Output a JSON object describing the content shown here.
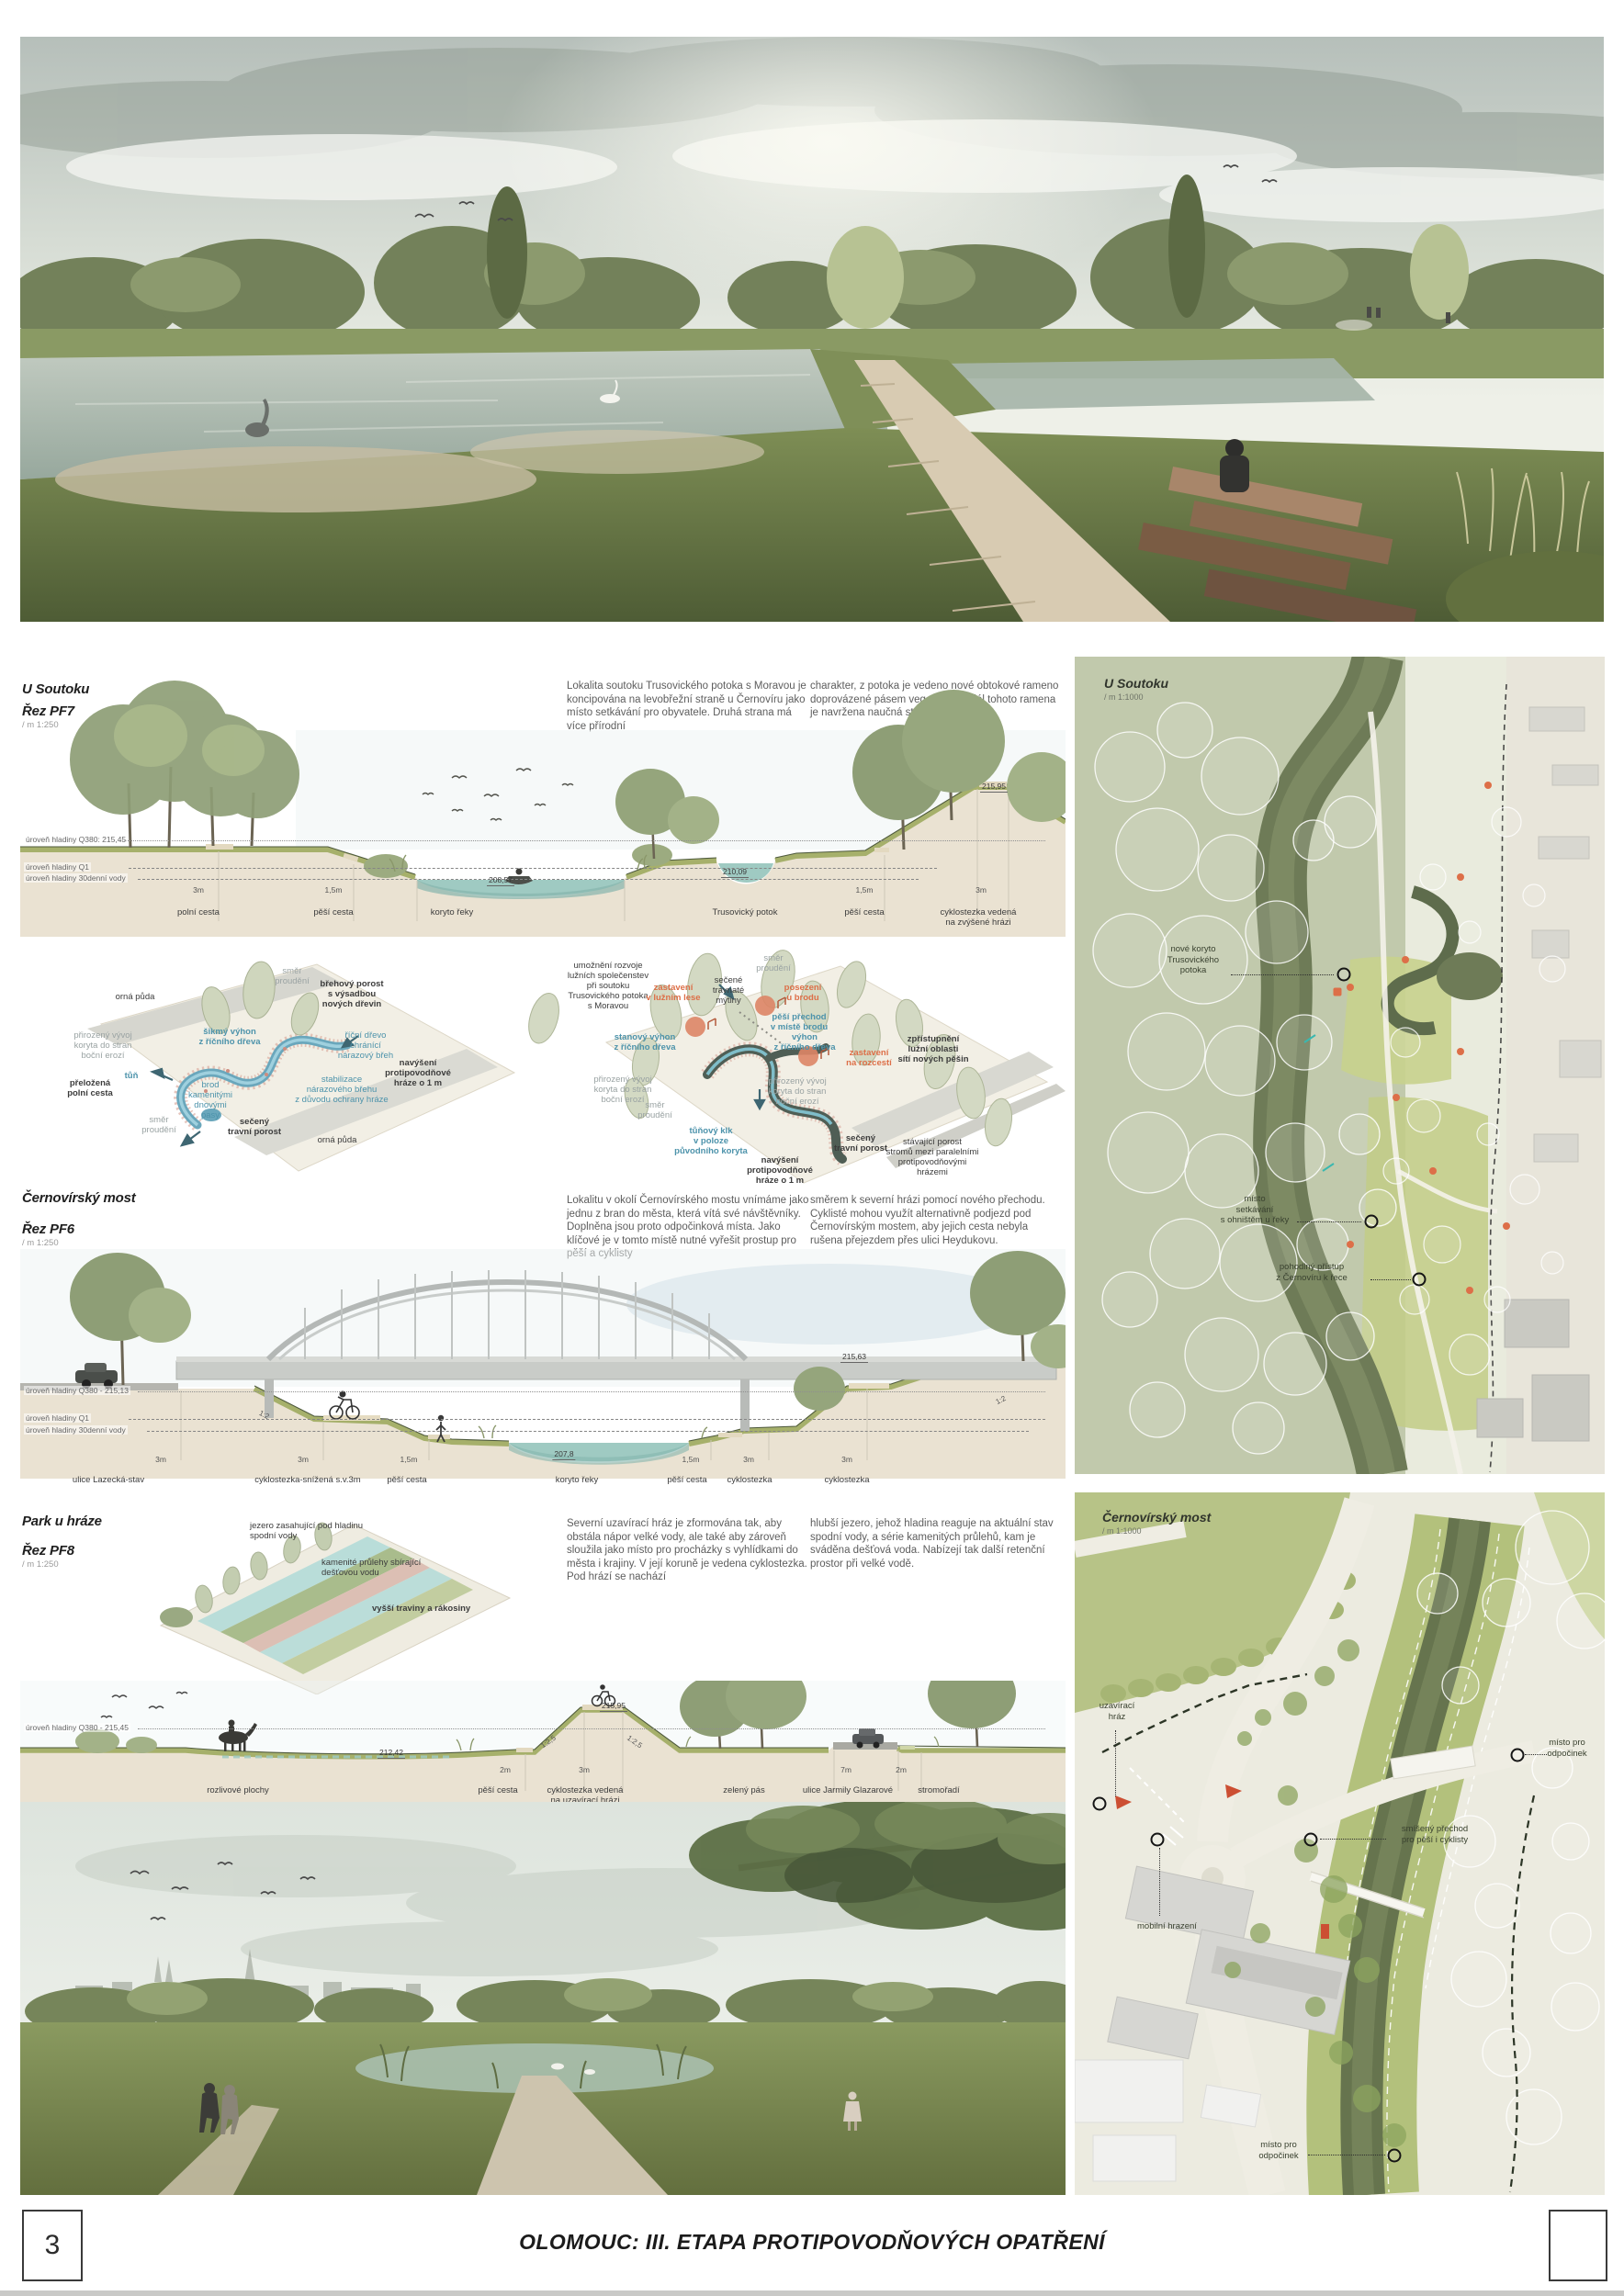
{
  "colors": {
    "accent_orange": "#dd6f48",
    "label_blue": "#4d93ab",
    "water_teal": "#9fcac2",
    "olive_green": "#a6b06b",
    "map_river": "#6e7b57"
  },
  "footer": {
    "page_number": "3",
    "title": "OLOMOUC: III. ETAPA PROTIPOVODŇOVÝCH OPATŘENÍ"
  },
  "pf7": {
    "title": "U Soutoku",
    "cut": "Řez PF7",
    "scale": "/ m 1:250",
    "para1": "Lokalita soutoku Trusovického potoka s Moravou je koncipována na levobřežní straně u Černovíru jako místo setkávání pro obyvatele. Druhá strana má více přírodní",
    "para2": "charakter, z potoka je vedeno nové obtokové rameno doprovázené pásem vegetace. Podél tohoto ramena je navržena naučná stezka.",
    "levels": [
      "úroveň hladiny Q380: 215,45",
      "úroveň hladiny Q1",
      "úroveň hladiny 30denní vody"
    ],
    "elevations": [
      "208,57",
      "210,09",
      "215,95"
    ],
    "dims": [
      "3m",
      "1,5m",
      "1,5m",
      "3m"
    ],
    "ground_labels": [
      "polní cesta",
      "pěší cesta",
      "koryto řeky",
      "Trusovický potok",
      "pěší cesta",
      "cyklostezka vedená\nna zvýšené hrázi"
    ]
  },
  "axon1": {
    "labels": [
      "orná půda",
      "směr\nproudění",
      "břehový porost\ns výsadbou\nnových dřevin",
      "přirozený vývoj\nkoryta do stran\nboční erozí",
      "šikmý výhon\nz říčního dřeva",
      "říční dřevo\nchránící\nnárazový břeh",
      "navýšení\nprotipovodňové\nhráze o 1 m",
      "tůň",
      "brod\nkamenitými\ndnovými\npasy",
      "přeložená\npolní cesta",
      "stabilizace\nnárazového břehu\nz důvodu ochrany hráze",
      "směr\nproudění",
      "sečený\ntravní porost",
      "orná půda"
    ]
  },
  "axon2": {
    "labels": [
      "umožnění rozvoje\nlužních společenstev\npři soutoku\nTrusovického potoka\ns Moravou",
      "zastavení\nv lužním lese",
      "sečené\ntravnaté\nmýtiny",
      "směr\nproudění",
      "posezení\nu brodu",
      "pěší přechod\nv místě brodu",
      "stanový výhon\nz říčního dřeva",
      "výhon\nz říčního dřeva",
      "zastavení\nna rozcestí",
      "zpřístupnění\nlužní oblasti\nsítí nových pěšin",
      "přirozený vývoj\nkoryta do stran\nboční erozí",
      "přirozený vývoj\nkoryta do stran\nboční erozí",
      "směr\nproudění",
      "tůňový klk\nv poloze\npůvodního koryta",
      "navýšení\nprotipovodňové\nhráze o 1 m",
      "sečený\ntravní porost",
      "stávající porost\nstromů mezi paralelními\nprotipovodňovými\nhrázemi"
    ]
  },
  "pf6": {
    "title": "Černovírský most",
    "cut": "Řez PF6",
    "scale": "/ m 1:250",
    "para1": "Lokalitu v okolí Černovírského mostu vnímáme jako jednu z bran do města, která vítá své návštěvníky. Doplněna jsou proto odpočinková místa. Jako klíčové je v tomto místě nutné vyřešit prostup pro pěší a cyklisty",
    "para2": "směrem k severní hrázi pomocí nového přechodu. Cyklisté mohou využít alternativně podjezd pod Černovírským mostem, aby jejich cesta nebyla rušena přejezdem přes ulici Heydukovu.",
    "levels": [
      "úroveň hladiny Q380 - 215,13",
      "úroveň hladiny Q1",
      "úroveň hladiny 30denní vody"
    ],
    "elevations": [
      "215,63",
      "207,8"
    ],
    "slopes": [
      "1:2",
      "1:2"
    ],
    "dims": [
      "3m",
      "3m",
      "1,5m",
      "1,5m",
      "3m",
      "3m"
    ],
    "ground_labels": [
      "ulice Lazecká-stav",
      "cyklostezka-snížená  s.v.3m",
      "pěší cesta",
      "koryto řeky",
      "pěší cesta",
      "cyklostezka",
      "cyklostezka"
    ]
  },
  "pf8": {
    "title": "Park u hráze",
    "cut": "Řez PF8",
    "scale": "/ m 1:250",
    "para1": "Severní uzavírací hráz je zformována tak, aby obstála nápor velké vody, ale také aby zároveň sloužila jako místo pro procházky s vyhlídkami do města i krajiny. V její koruně je vedena cyklostezka. Pod hrází se nachází",
    "para2": "hlubší jezero, jehož hladina reaguje na aktuální stav spodní vody, a série kamenitých průlehů, kam je sváděna dešťová voda. Nabízejí tak další retenční prostor při velké vodě.",
    "axon_labels": [
      "jezero zasahující pod hladinu\nspodní vody",
      "kamenité průlehy sbírající\ndešťovou vodu",
      "vyšší traviny a rákosiny"
    ],
    "level": "úroveň hladiny Q380 - 215,45",
    "elevations": [
      "215,95",
      "212,42"
    ],
    "slopes": [
      "1:2,5",
      "1:2,5"
    ],
    "dims": [
      "2m",
      "3m",
      "7m",
      "2m"
    ],
    "ground_labels": [
      "rozlivové plochy",
      "pěší cesta",
      "cyklostezka vedená\nna uzavírací hrázi",
      "zelený pás",
      "ulice Jarmily Glazarové",
      "stromořadí"
    ]
  },
  "map1": {
    "title": "U Soutoku",
    "scale": "/ m 1:1000",
    "annotations": [
      "nové koryto\nTrusovického\npotoka",
      "místo\nsetkávání\ns ohništěm u řeky",
      "pohodlný přístup\nz Černovíru k řece"
    ]
  },
  "map2": {
    "title": "Černovírský most",
    "scale": "/ m 1:1000",
    "annotations": [
      "uzavírací\nhráz",
      "místo pro\nodpočinek",
      "smíšený přechod\npro pěší i cyklisty",
      "mobilní hrazení",
      "místo pro\nodpočinek"
    ]
  }
}
